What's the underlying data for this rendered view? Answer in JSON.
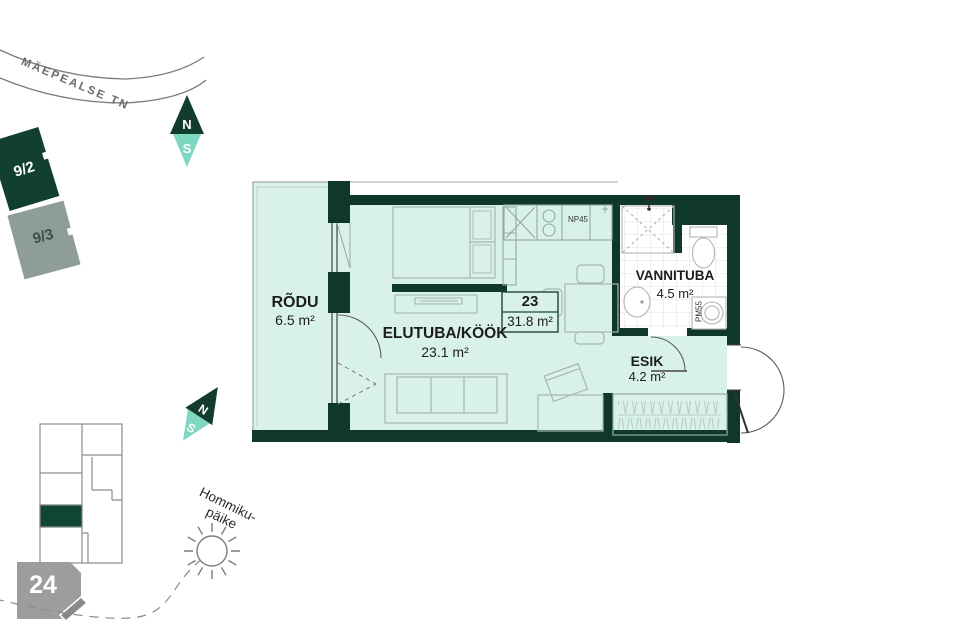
{
  "site": {
    "street_name": "MÄEPEALSE TN",
    "building_9_2": "9/2",
    "building_9_3": "9/3",
    "sun_label_line1": "Hommiku-",
    "sun_label_line2": "päike",
    "key_plan_number": "24",
    "compass_top": {
      "north": "N",
      "south": "S"
    },
    "compass_left": {
      "north": "N",
      "south": "S"
    }
  },
  "apartment": {
    "number": "23",
    "total_area": "31.8 m²",
    "rooms": [
      {
        "name": "RÕDU",
        "area": "6.5 m²"
      },
      {
        "name": "ELUTUBA/KÖÖK",
        "area": "23.1 m²"
      },
      {
        "name": "VANNITUBA",
        "area": "4.5 m²"
      },
      {
        "name": "ESIK",
        "area": "4.2 m²"
      }
    ],
    "appliance_codes": {
      "stove": "NP45",
      "washing_machine": "PM55"
    }
  },
  "colors": {
    "wall_dark_green": "#10382a",
    "room_fill_teal": "#d8f2eb",
    "compass_south_teal": "#7ed8c1",
    "building_muted_gray_green": "#8e9e96",
    "key_plan_highlight_green": "#0f4631",
    "tag_gray": "#9d9d9d",
    "map_line_gray": "#8c8c8c"
  }
}
